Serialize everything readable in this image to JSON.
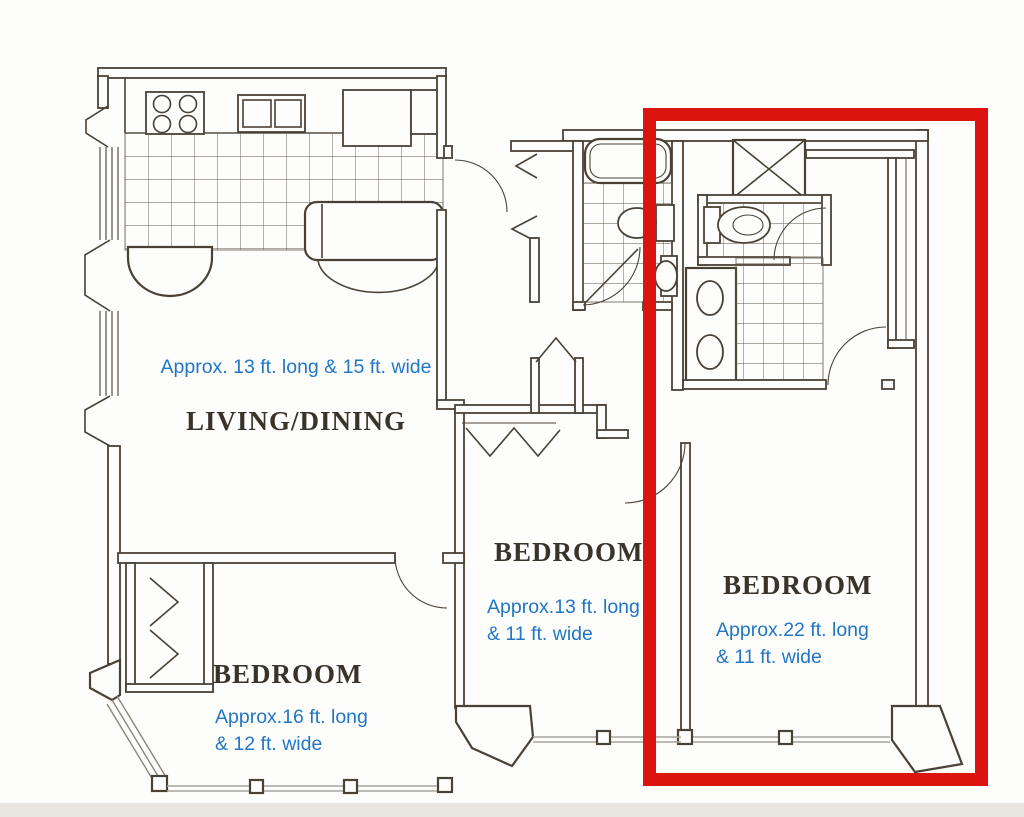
{
  "title": "Apartment floor plan",
  "rooms": {
    "living": {
      "name": "LIVING/DINING",
      "dimensions": "Approx. 13 ft. long & 15 ft. wide"
    },
    "bedroom1": {
      "name": "BEDROOM",
      "dim_line1": "Approx.16 ft. long",
      "dim_line2": "& 12 ft. wide"
    },
    "bedroom2": {
      "name": "BEDROOM",
      "dim_line1": "Approx.13 ft. long",
      "dim_line2": "& 11 ft. wide"
    },
    "bedroom3": {
      "name": "BEDROOM",
      "dim_line1": "Approx.22 ft. long",
      "dim_line2": "& 11 ft. wide"
    }
  },
  "highlight": {
    "note": "red rectangle outlining the right bedroom and bathroom suite",
    "color": "#dc1410"
  },
  "colors": {
    "wall": "#4a4136",
    "tile": "#5f5749",
    "window": "#aaa49b",
    "glass": "#8d857a",
    "red": "#dc1410",
    "blue": "#2276c5",
    "darktext": "#3a332a",
    "bg": "#fdfdfb",
    "band": "#e9e6e1"
  }
}
